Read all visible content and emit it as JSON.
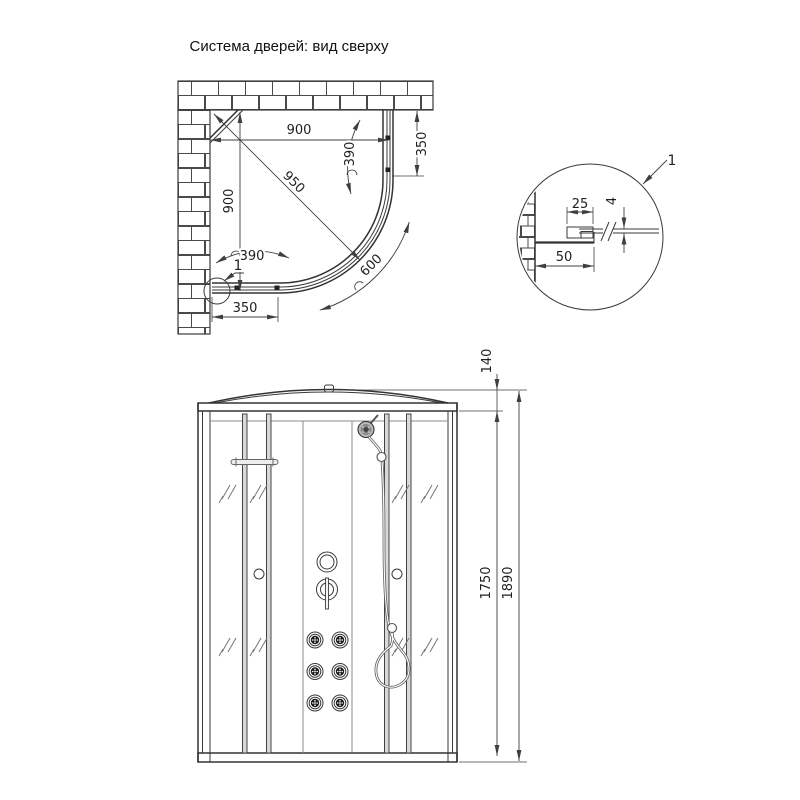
{
  "title": "Система дверей: вид сверху",
  "colors": {
    "line": "#3a3a3a",
    "dim_text": "#1f1f1f",
    "post_fill": "#d9d9d9",
    "glass_hatch": "#777777",
    "background": "#ffffff"
  },
  "top_view": {
    "dim_width_top": "900",
    "dim_depth_left": "900",
    "dim_diagonal": "950",
    "dim_door_arc_right": "390",
    "dim_door_arc_bottom": "390",
    "dim_side_panel_right": "350",
    "dim_side_panel_bottom": "350",
    "dim_opening_arc": "600",
    "detail_callout": "1"
  },
  "detail_view": {
    "callout": "1",
    "dim_profile_width": "25",
    "dim_glass_thickness": "4",
    "dim_wall_profile_depth": "50"
  },
  "front_view": {
    "dim_roof_height": "140",
    "dim_body_height": "1750",
    "dim_total_height": "1890"
  }
}
